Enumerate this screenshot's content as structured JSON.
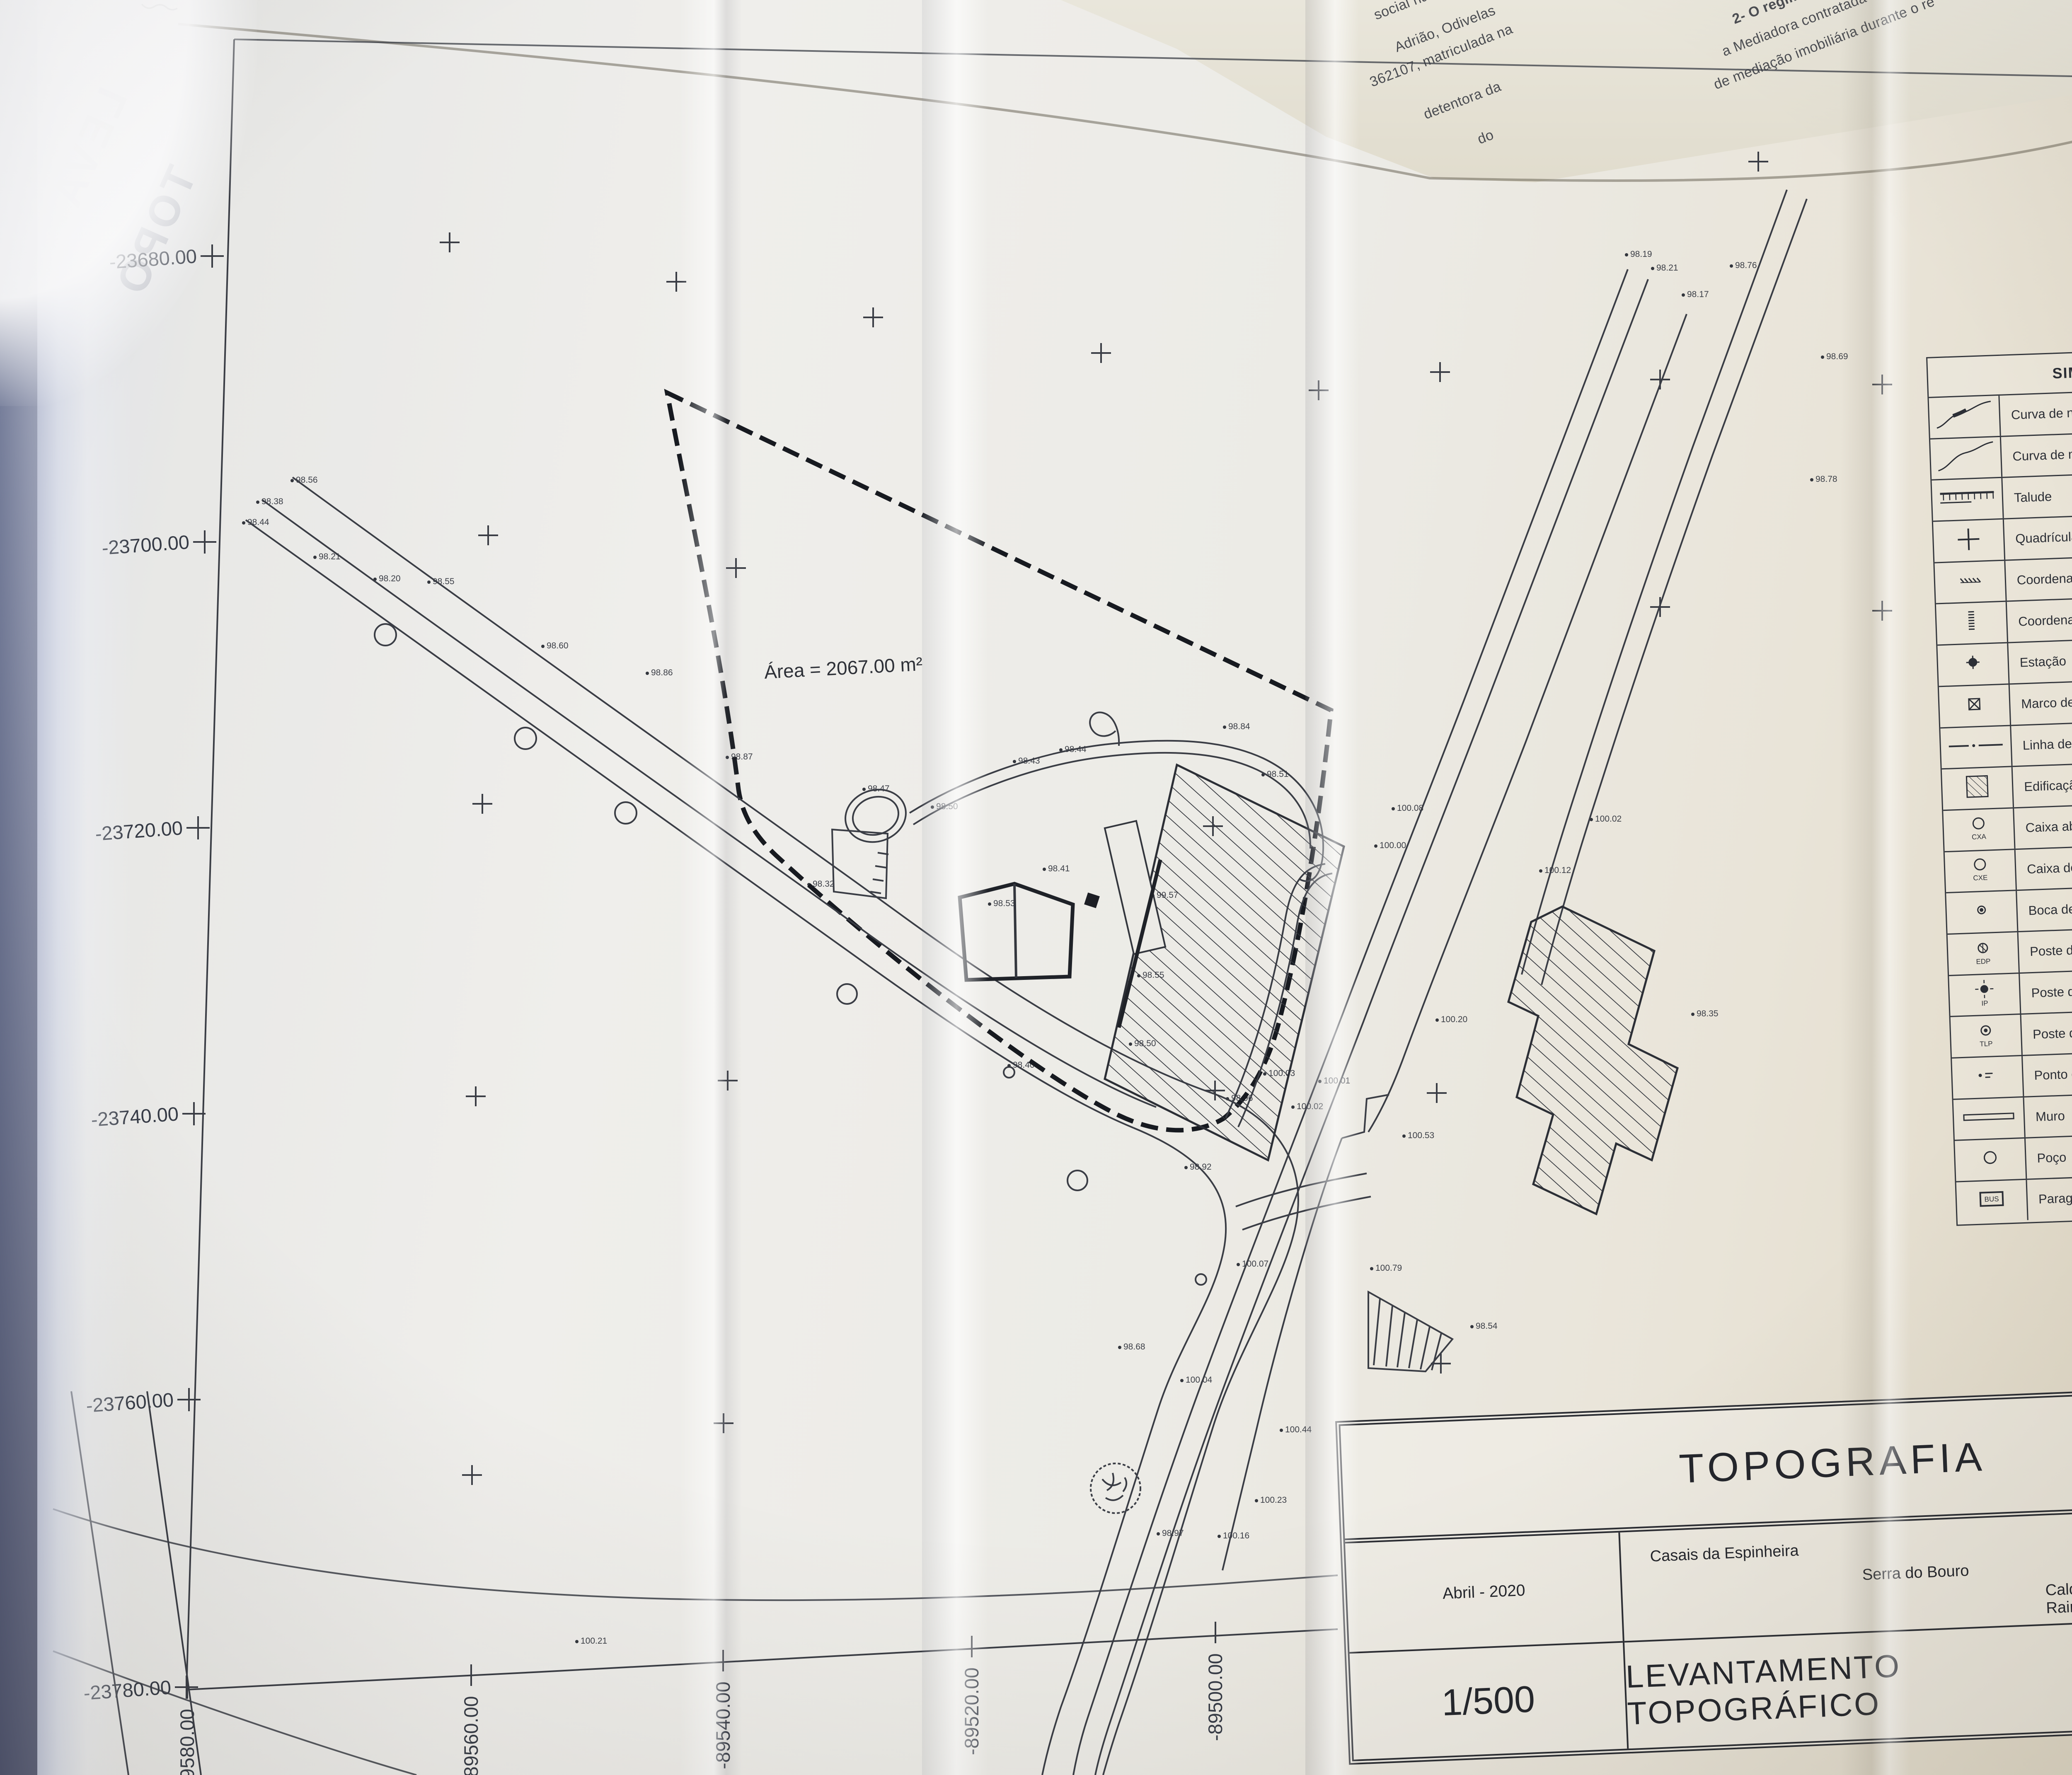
{
  "axes": {
    "y_labels": [
      "-23680.00",
      "-23700.00",
      "-23720.00",
      "-23740.00",
      "-23760.00",
      "-23780.00"
    ],
    "y_ticks": [
      [
        512,
        618
      ],
      [
        494,
        1308
      ],
      [
        478,
        1998
      ],
      [
        468,
        2688
      ],
      [
        456,
        3378
      ],
      [
        450,
        4072
      ]
    ],
    "x_labels": [
      "-89580.00",
      "-89560.00",
      "-89540.00",
      "-89520.00",
      "-89500.00"
    ],
    "x_ticks": [
      [
        452,
        4074
      ],
      [
        1137,
        4043
      ],
      [
        1745,
        4008
      ],
      [
        2345,
        3974
      ],
      [
        2933,
        3940
      ]
    ]
  },
  "map": {
    "area_label": "Área = 2067.00 m²",
    "north_label": "NORTE",
    "grid_crosses": [
      [
        1085,
        585
      ],
      [
        1632,
        680
      ],
      [
        2107,
        766
      ],
      [
        2657,
        852
      ],
      [
        3182,
        942
      ],
      [
        4243,
        390
      ],
      [
        1178,
        1292
      ],
      [
        1776,
        1371
      ],
      [
        3475,
        898
      ],
      [
        4006,
        916
      ],
      [
        4542,
        928
      ],
      [
        1164,
        1940
      ],
      [
        2927,
        1994
      ],
      [
        4006,
        1465
      ],
      [
        4542,
        1474
      ],
      [
        1148,
        2646
      ],
      [
        1756,
        2608
      ],
      [
        2932,
        2632
      ],
      [
        3467,
        2638
      ],
      [
        1139,
        3560
      ],
      [
        1746,
        3435
      ],
      [
        3477,
        3291
      ]
    ],
    "utility_circles": [
      [
        930,
        1532,
        26
      ],
      [
        1268,
        1782,
        26
      ],
      [
        1510,
        1962,
        26
      ],
      [
        2044,
        2399,
        24
      ],
      [
        2600,
        2849,
        24
      ],
      [
        2435,
        2588,
        13
      ],
      [
        2898,
        3088,
        13
      ]
    ],
    "spot_elevations": [
      [
        705,
        1160,
        "98.56"
      ],
      [
        622,
        1212,
        "98.38"
      ],
      [
        588,
        1262,
        "98.44"
      ],
      [
        760,
        1345,
        "98.21"
      ],
      [
        905,
        1398,
        "98.20"
      ],
      [
        1035,
        1405,
        "98.55"
      ],
      [
        1310,
        1560,
        "98.60"
      ],
      [
        1562,
        1625,
        "98.86"
      ],
      [
        1755,
        1828,
        "98.87"
      ],
      [
        2250,
        1948,
        "98.50"
      ],
      [
        2448,
        1838,
        "98.43"
      ],
      [
        2560,
        1810,
        "98.44"
      ],
      [
        2955,
        1755,
        "98.84"
      ],
      [
        3048,
        1870,
        "98.51"
      ],
      [
        2520,
        2098,
        "98.41"
      ],
      [
        2388,
        2182,
        "98.53"
      ],
      [
        2782,
        2162,
        "99.57"
      ],
      [
        2748,
        2355,
        "98.55"
      ],
      [
        2728,
        2520,
        "98.50"
      ],
      [
        3052,
        2592,
        "100.03"
      ],
      [
        2962,
        2652,
        "98.96"
      ],
      [
        3120,
        2672,
        "100.02"
      ],
      [
        3185,
        2610,
        "100.01"
      ],
      [
        2862,
        2818,
        "98.92"
      ],
      [
        3320,
        2042,
        "100.00"
      ],
      [
        3362,
        1952,
        "100.08"
      ],
      [
        3718,
        2102,
        "100.12"
      ],
      [
        3840,
        1978,
        "100.02"
      ],
      [
        4178,
        642,
        "98.76"
      ],
      [
        3925,
        615,
        "98.19"
      ],
      [
        3988,
        648,
        "98.21"
      ],
      [
        4062,
        712,
        "98.17"
      ],
      [
        4398,
        862,
        "98.69"
      ],
      [
        4372,
        1158,
        "98.78"
      ],
      [
        3468,
        2462,
        "100.20"
      ],
      [
        3388,
        2742,
        "100.53"
      ],
      [
        3310,
        3062,
        "100.79"
      ],
      [
        3552,
        3202,
        "98.54"
      ],
      [
        4085,
        2448,
        "98.35"
      ],
      [
        2988,
        3052,
        "100.07"
      ],
      [
        2702,
        3252,
        "98.68"
      ],
      [
        2852,
        3332,
        "100.04"
      ],
      [
        3092,
        3452,
        "100.44"
      ],
      [
        3032,
        3622,
        "100.23"
      ],
      [
        2795,
        3702,
        "98.97"
      ],
      [
        2942,
        3708,
        "100.16"
      ],
      [
        1392,
        3962,
        "100.21"
      ],
      [
        2085,
        1905,
        "98.47"
      ],
      [
        1952,
        2135,
        "98.32"
      ],
      [
        2435,
        2572,
        "98.40"
      ]
    ]
  },
  "legend": {
    "title": "SIMBOLOGIA",
    "items": [
      {
        "icon": "contour-master-icon",
        "label": "Curva de nível mestra com cota"
      },
      {
        "icon": "contour-secondary-icon",
        "label": "Curva de nível secundária"
      },
      {
        "icon": "slope-icon",
        "label": "Talude"
      },
      {
        "icon": "grid-cross-icon",
        "label": "Quadrícula de coordenação"
      },
      {
        "icon": "coordinate-p-icon",
        "label": "Coordenada p"
      },
      {
        "icon": "coordinate-m-icon",
        "label": "Coordenada m"
      },
      {
        "icon": "station-icon",
        "label": "Estação"
      },
      {
        "icon": "property-marker-icon",
        "label": "Marco de estrema de propriedade"
      },
      {
        "icon": "boundary-line-icon",
        "label": "Linha de estrema"
      },
      {
        "icon": "building-icon",
        "label": "Edificação"
      },
      {
        "icon": "water-box-icon",
        "label": "Caixa abastecimento de água",
        "tag": "CXA"
      },
      {
        "icon": "sewer-box-icon",
        "label": "Caixa de esgoto doméstico",
        "tag": "CXE"
      },
      {
        "icon": "fire-hydrant-icon",
        "label": "Boca de incêndio"
      },
      {
        "icon": "edp-pole-icon",
        "label": "Poste distribuição EDP",
        "tag": "EDP"
      },
      {
        "icon": "light-pole-icon",
        "label": "Poste de iluminação",
        "tag": "IP"
      },
      {
        "icon": "telecom-pole-icon",
        "label": "Poste de telecomunicações",
        "tag": "TLP"
      },
      {
        "icon": "spot-height-icon",
        "label": "Ponto de cota"
      },
      {
        "icon": "wall-icon",
        "label": "Muro"
      },
      {
        "icon": "well-icon",
        "label": "Poço"
      },
      {
        "icon": "bus-stop-icon",
        "label": "Paragem BUS",
        "tag": "BUS"
      }
    ]
  },
  "title_block": {
    "title": "TOPOGRAFIA",
    "date": "Abril - 2020",
    "place_parish": "Casais da Espinheira",
    "place_municipality_area": "Serra do Bouro",
    "place_city": "Caldas da Rainha",
    "sheet_number": "02",
    "scale": "1/500",
    "subtitle": "LEVANTAMENTO TOPOGRÁFICO"
  },
  "underlying_document": {
    "left_fragments": [
      "social na",
      "Adrião, Odivelas",
      "362107, matriculada na",
      "detentora da",
      "do"
    ],
    "right_fragments": [
      "2- O regime de",
      "a Mediadora contratada tem",
      "de mediação imobiliária durante o re",
      "áusula 5.ª"
    ],
    "corner_fragment": "ressado que",
    "edge_letters": [
      "de",
      "ço",
      "do",
      "de",
      "e",
      "m",
      "s",
      "ç",
      "a",
      "g",
      "o"
    ]
  },
  "bleedthrough": {
    "line1": "LEVA",
    "line2": "TOPO"
  },
  "colors": {
    "ink": "#2b2e36",
    "paper": "#ecebe6",
    "cloth": "#b3a286",
    "fold_blue": "#8e97b4"
  }
}
